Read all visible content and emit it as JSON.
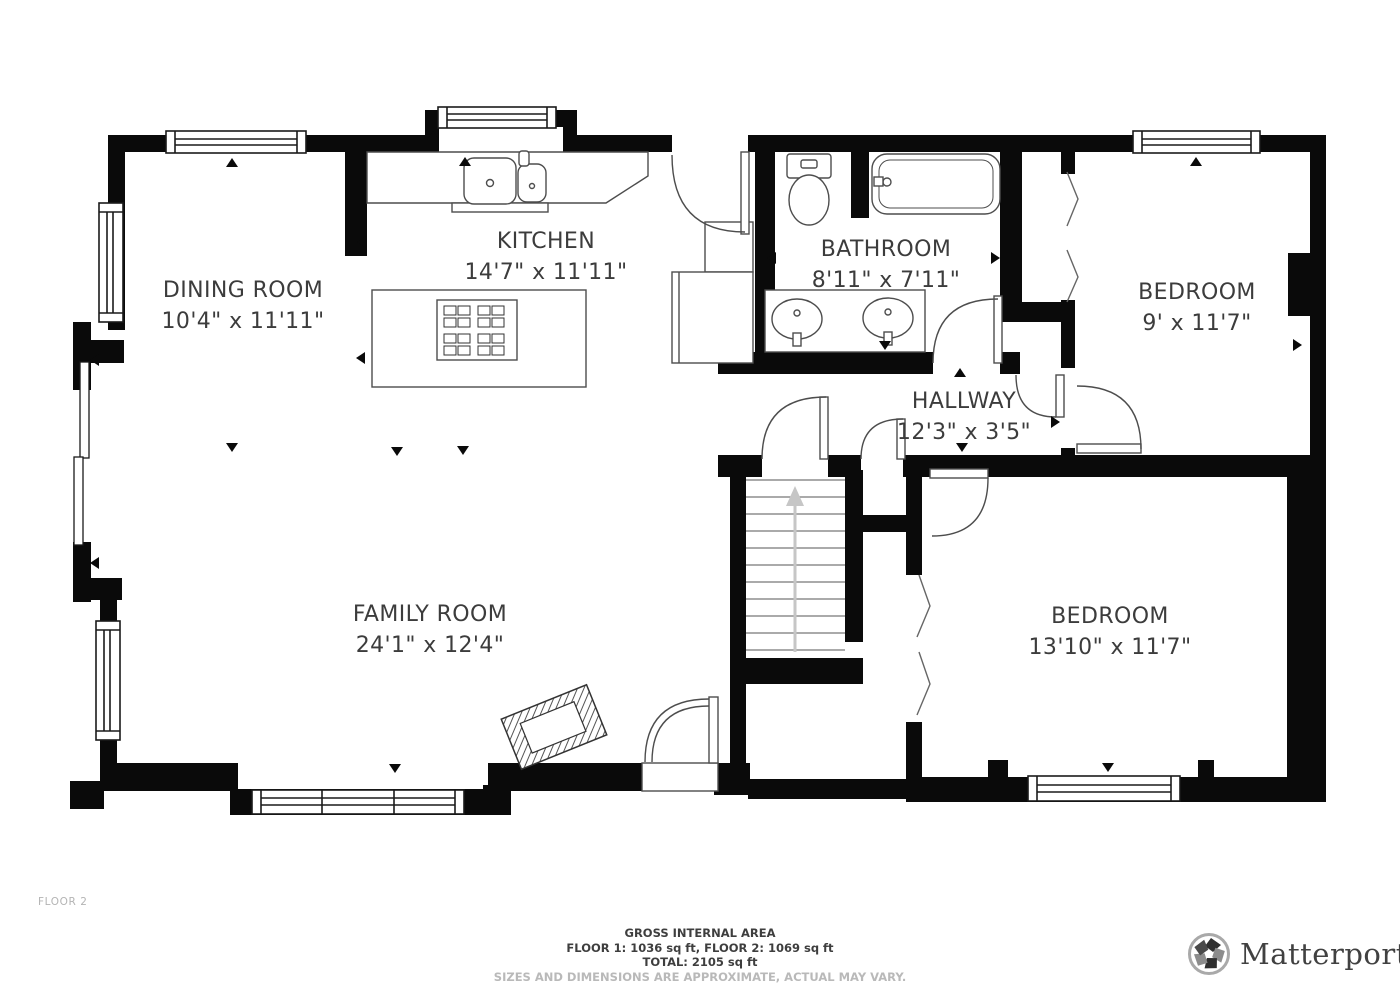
{
  "plan": {
    "floor_label": "FLOOR 2",
    "rooms": [
      {
        "name": "DINING ROOM",
        "dims": "10'4\" x 11'11\""
      },
      {
        "name": "KITCHEN",
        "dims": "14'7\" x 11'11\""
      },
      {
        "name": "BATHROOM",
        "dims": "8'11\" x 7'11\""
      },
      {
        "name": "BEDROOM",
        "dims": "9' x 11'7\""
      },
      {
        "name": "HALLWAY",
        "dims": "12'3\" x 3'5\""
      },
      {
        "name": "FAMILY ROOM",
        "dims": "24'1\" x 12'4\""
      },
      {
        "name": "BEDROOM",
        "dims": "13'10\" x 11'7\""
      }
    ],
    "colors": {
      "wall": "#0a0a0a",
      "line": "#4d4d4d",
      "label": "#3c3c3c",
      "muted": "#b9b9b9"
    }
  },
  "footer": {
    "area_title": "GROSS INTERNAL AREA",
    "area_line1": "FLOOR 1: 1036 sq ft, FLOOR 2: 1069 sq ft",
    "area_line2": "TOTAL: 2105 sq ft",
    "disclaimer": "SIZES AND DIMENSIONS ARE APPROXIMATE, ACTUAL MAY VARY.",
    "brand": "Matterport",
    "brand_mark": "®"
  }
}
